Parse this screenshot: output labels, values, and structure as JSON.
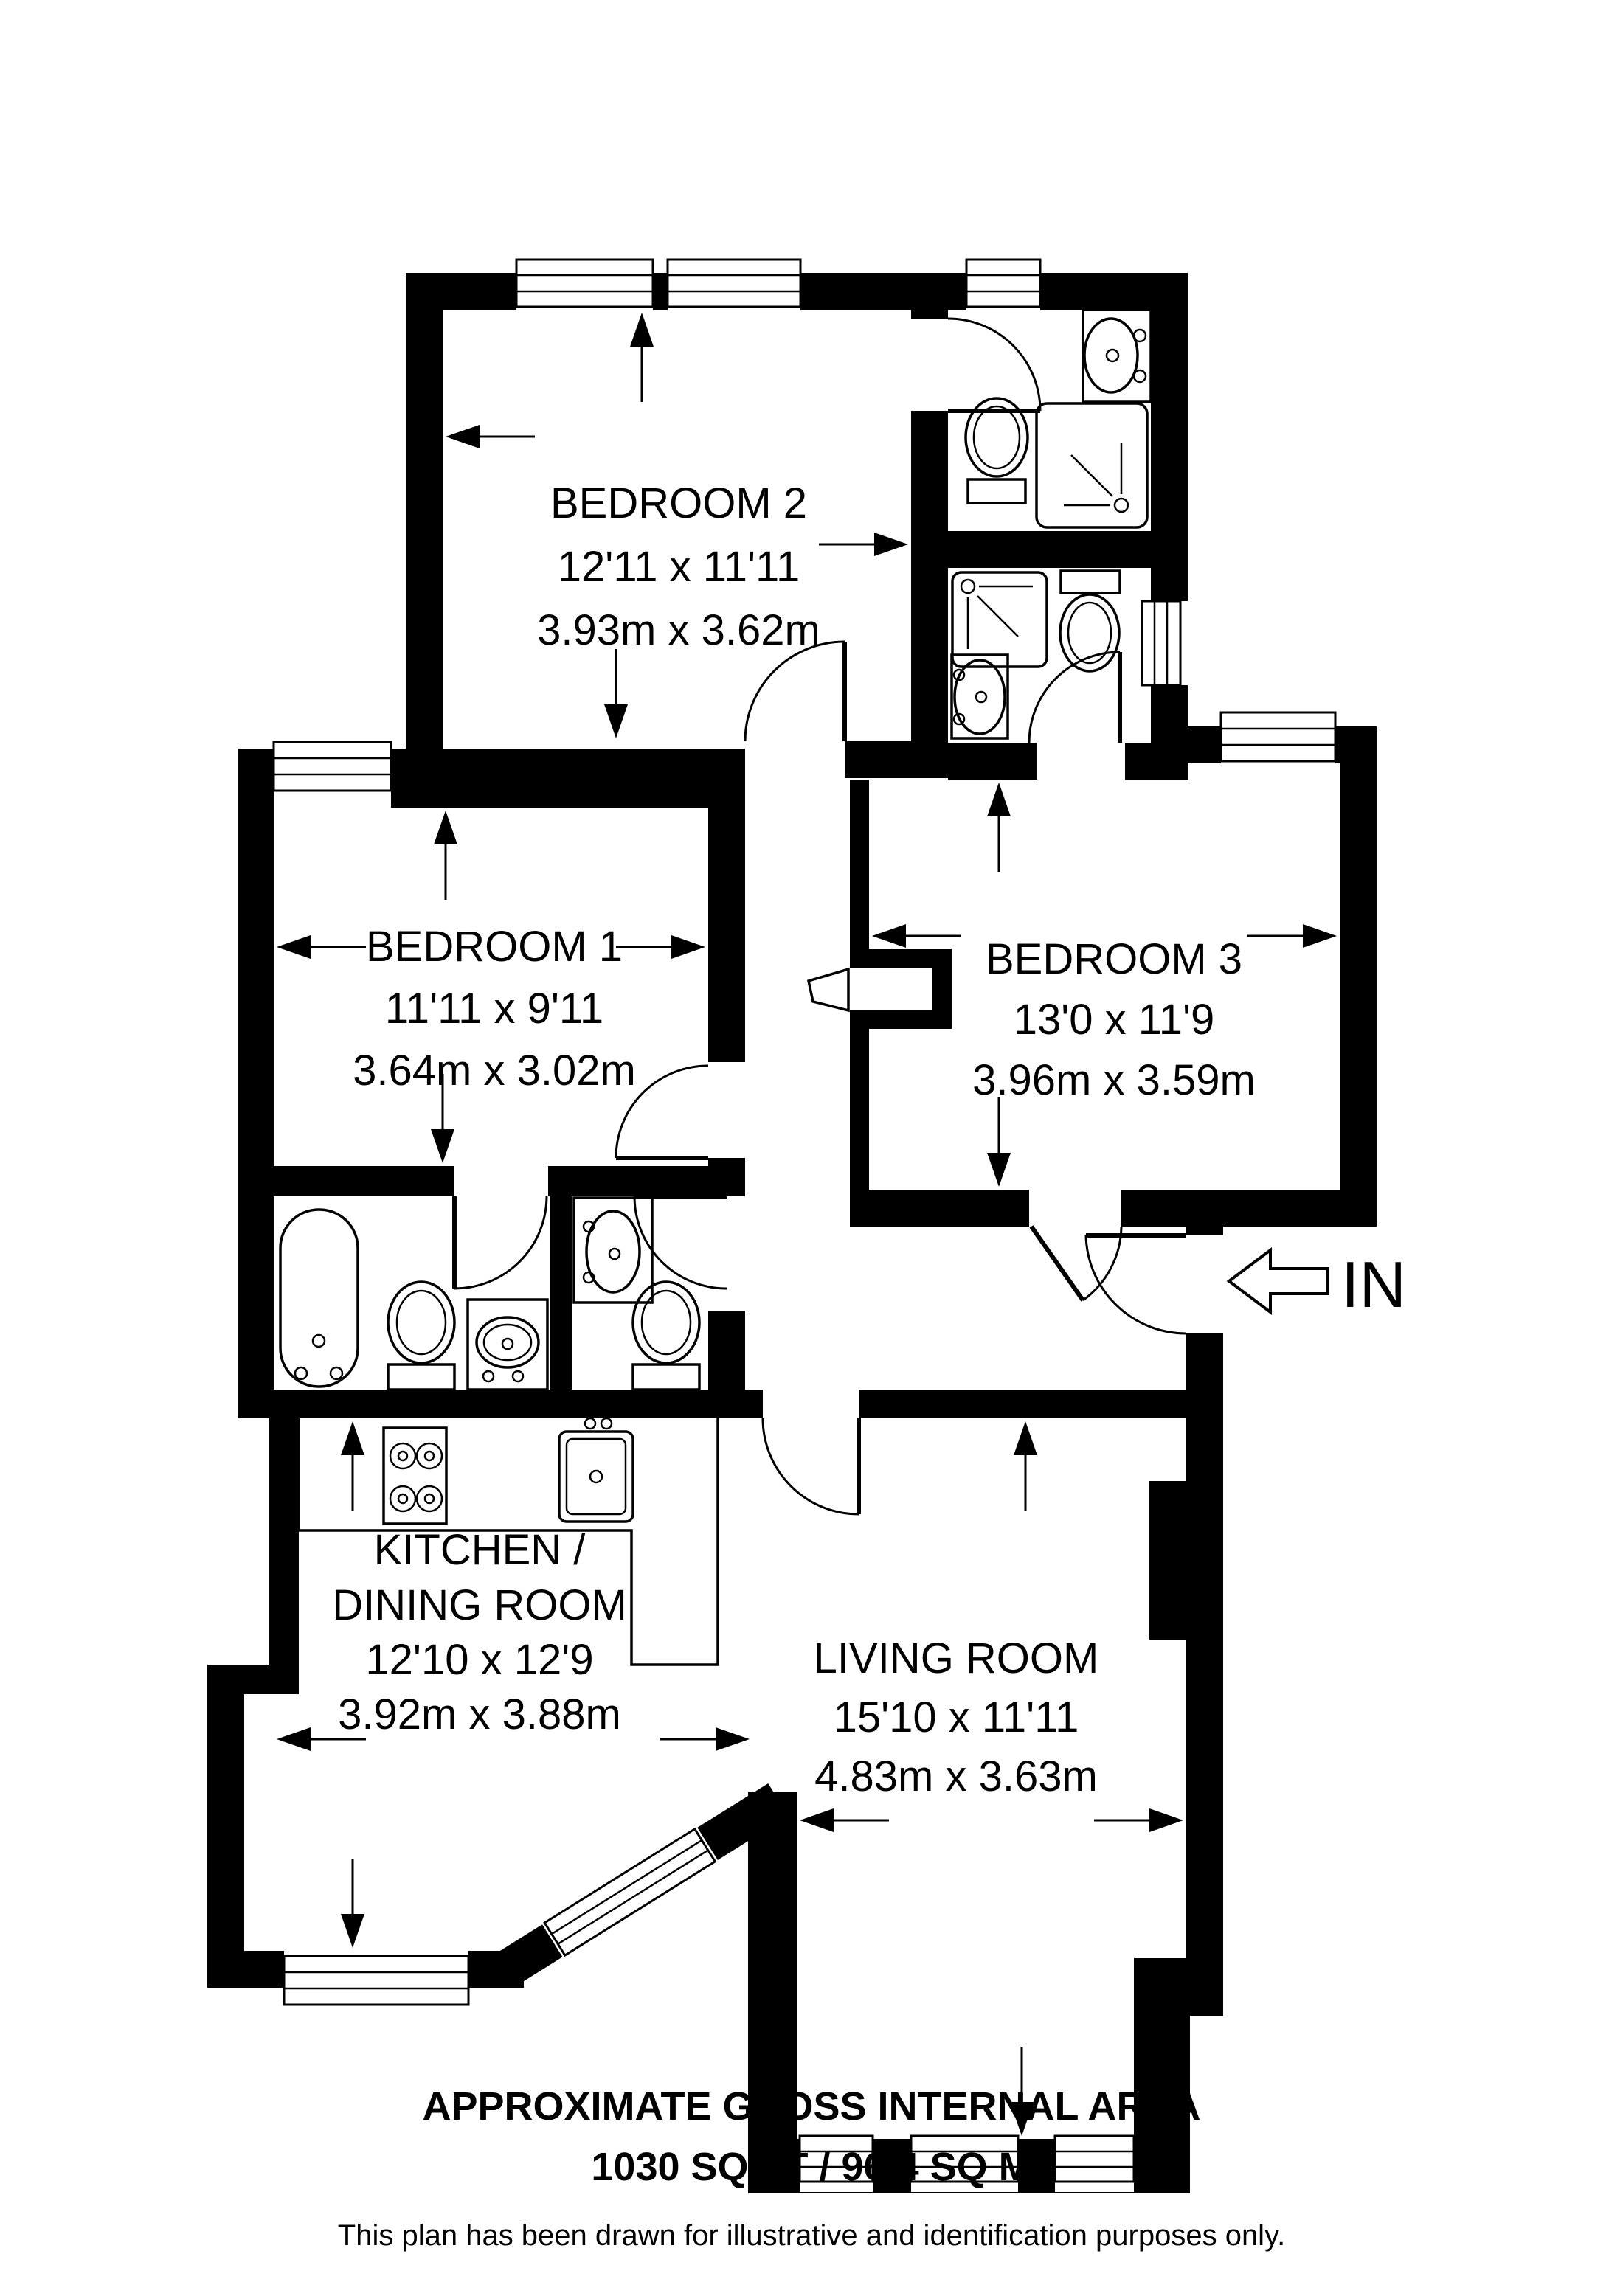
{
  "plan": {
    "rooms": [
      {
        "id": "bedroom2",
        "name": "BEDROOM 2",
        "size_imperial": "12'11 x 11'11",
        "size_metric": "3.93m x 3.62m"
      },
      {
        "id": "bedroom1",
        "name": "BEDROOM 1",
        "size_imperial": "11'11 x 9'11",
        "size_metric": "3.64m x 3.02m"
      },
      {
        "id": "bedroom3",
        "name": "BEDROOM 3",
        "size_imperial": "13'0 x 11'9",
        "size_metric": "3.96m x 3.59m"
      },
      {
        "id": "kitchen-dining",
        "name_line1": "KITCHEN /",
        "name_line2": "DINING ROOM",
        "size_imperial": "12'10 x 12'9",
        "size_metric": "3.92m x 3.88m"
      },
      {
        "id": "living-room",
        "name": "LIVING ROOM",
        "size_imperial": "15'10 x 11'11",
        "size_metric": "4.83m x 3.63m"
      }
    ],
    "entrance_label": "IN",
    "footer": {
      "title": "APPROXIMATE GROSS INTERNAL AREA",
      "area": "1030 SQ FT / 96.4 SQ M",
      "disclaimer": "This plan has been drawn for illustrative and identification purposes only."
    },
    "colors": {
      "walls": "#000000",
      "background": "#ffffff"
    }
  }
}
